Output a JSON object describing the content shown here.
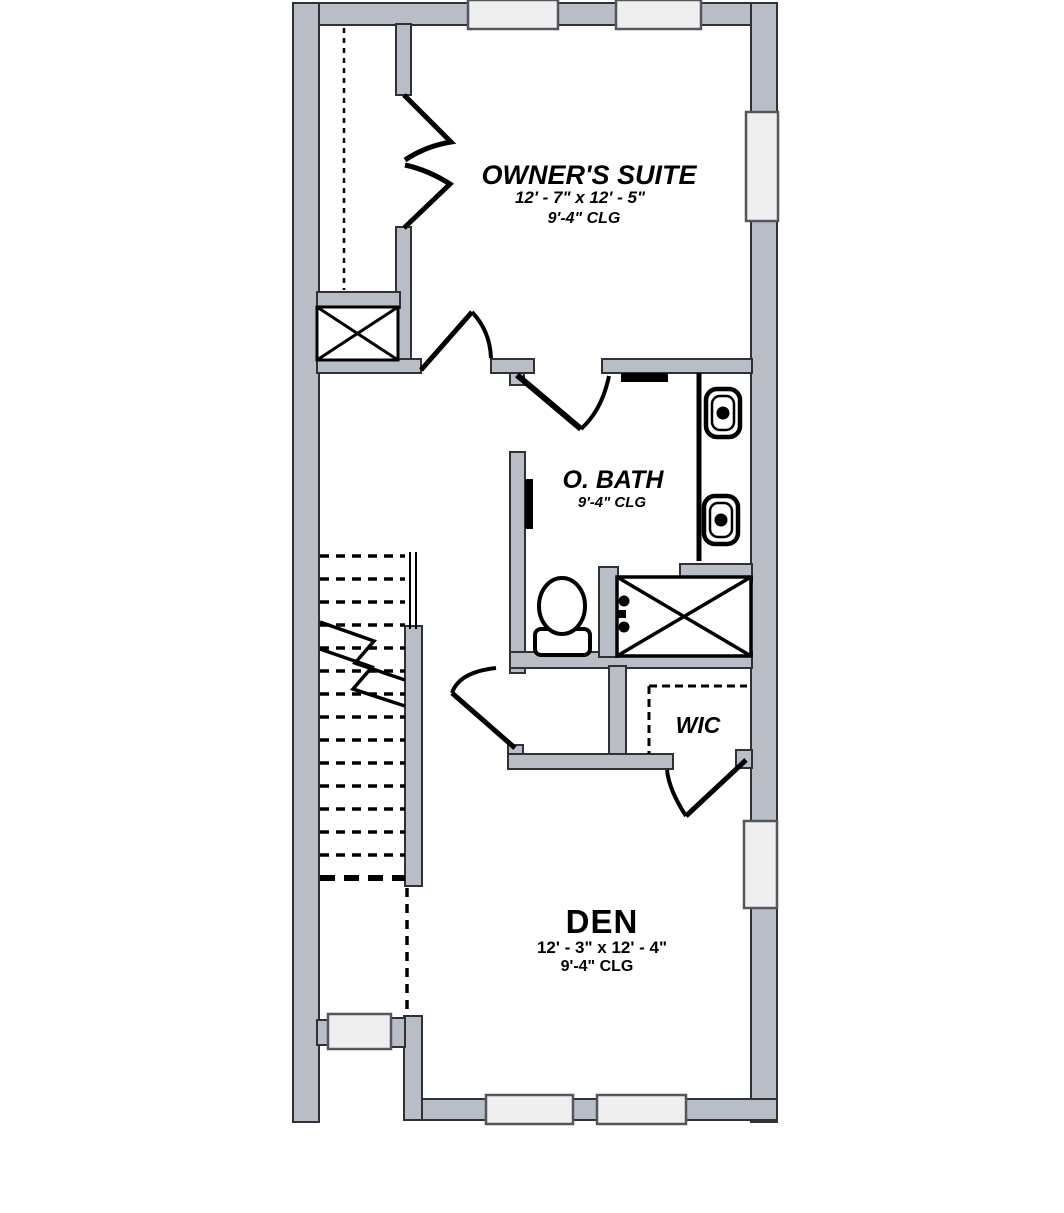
{
  "palette": {
    "wall_fill": "#b9bec6",
    "wall_outline": "#2e3237",
    "window_fill": "#efefef",
    "window_outline": "#53575d",
    "line_color": "#000000",
    "background": "#ffffff"
  },
  "rooms": {
    "owners_suite": {
      "name": "OWNER'S SUITE",
      "dimensions": "12' - 7\" x 12' - 5\"",
      "ceiling": "9'-4\" CLG"
    },
    "o_bath": {
      "name": "O. BATH",
      "ceiling": "9'-4\" CLG"
    },
    "wic": {
      "name": "WIC"
    },
    "den": {
      "name": "DEN",
      "dimensions": "12' - 3\" x 12' - 4\"",
      "ceiling": "9'-4\" CLG"
    }
  }
}
